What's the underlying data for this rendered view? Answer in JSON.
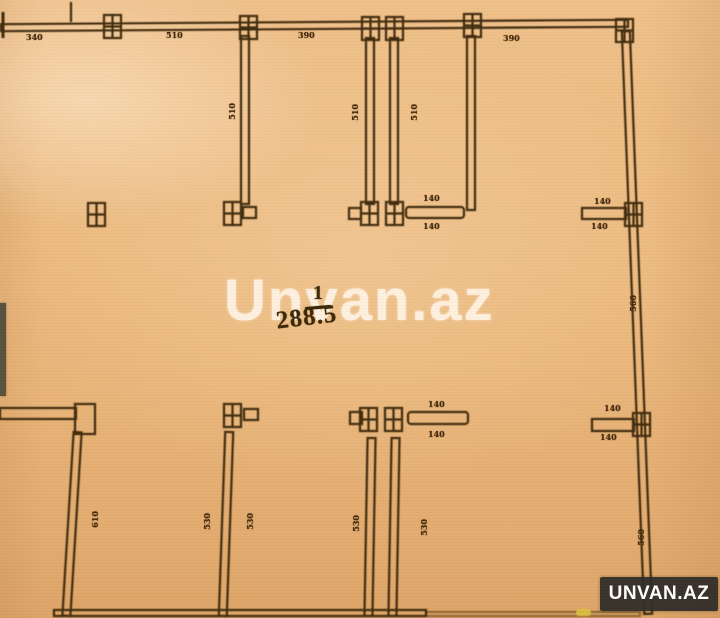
{
  "plan": {
    "watermark": "Unvan.az",
    "brand": "UNVAN.AZ",
    "room": {
      "number": "1",
      "area": "288.5"
    },
    "dims": {
      "top": [
        "340",
        "510",
        "390",
        "390"
      ],
      "upper_walls": [
        "510",
        "510",
        "510"
      ],
      "right_wall": [
        "560",
        "560"
      ],
      "upper_center_stub": [
        "140",
        "140"
      ],
      "upper_right_stub": [
        "140",
        "140"
      ],
      "lower_center_stub": [
        "140",
        "140"
      ],
      "lower_right_stub": [
        "140",
        "140"
      ],
      "lower_walls": [
        "610",
        "530",
        "530",
        "530",
        "530"
      ]
    }
  },
  "colors": {
    "paper": "#e8b478",
    "ink": "#3f2c0c",
    "watermark_text": "#fff3e4",
    "logo_background": "#2e2b26",
    "logo_text": "#ffffff"
  }
}
